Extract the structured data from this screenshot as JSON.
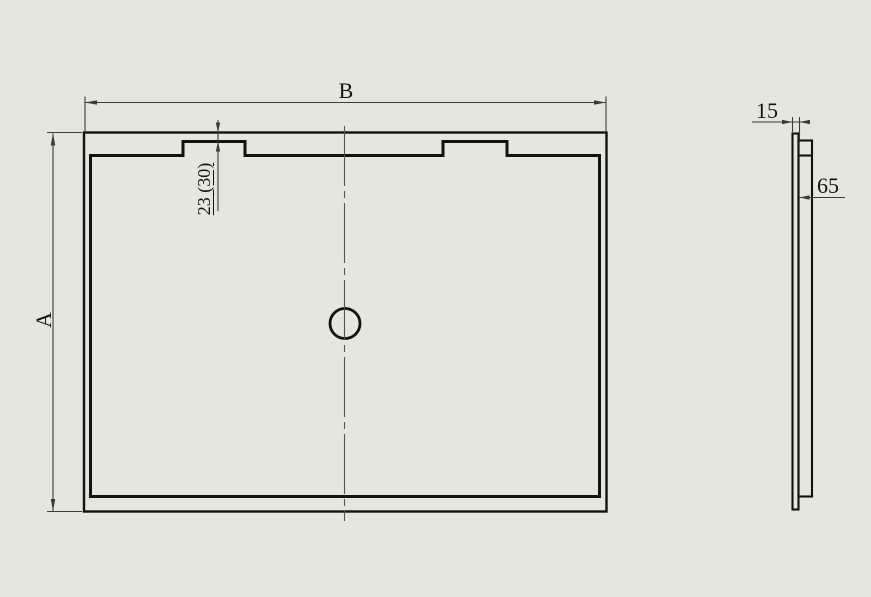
{
  "colors": {
    "background": "#e5e6dd",
    "line": "#121210",
    "dimension": "#3c3c34",
    "centerline": "#53564c"
  },
  "views": {
    "front": {
      "dimensions": {
        "width_label": "B",
        "height_label": "A",
        "tab_note": "23 (30)"
      }
    },
    "side": {
      "dimensions": {
        "thickness": "15",
        "rim_depth": "65"
      }
    }
  }
}
